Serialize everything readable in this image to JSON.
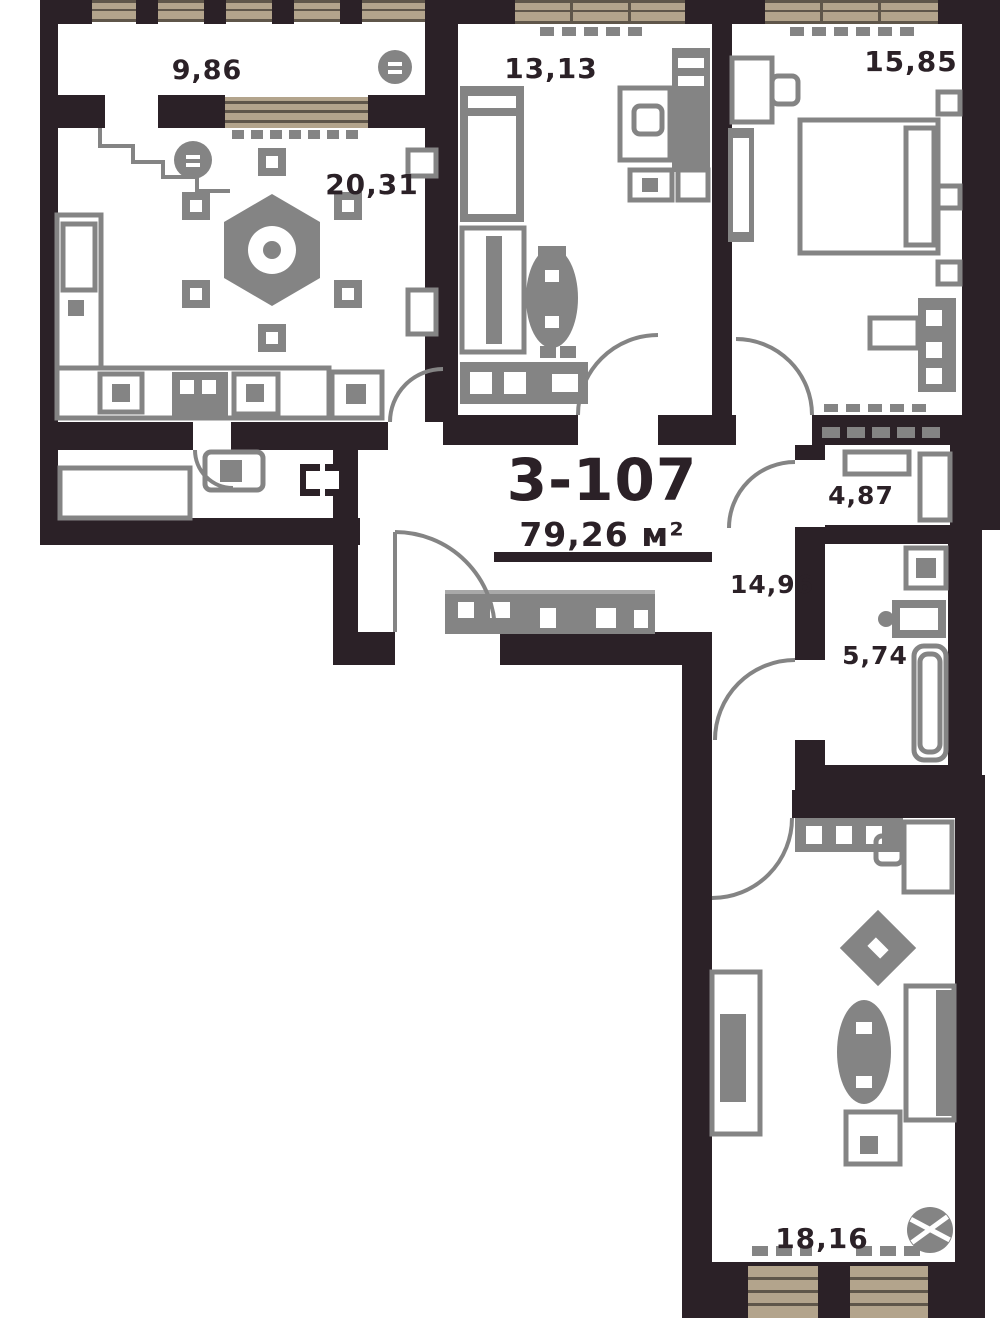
{
  "unit": {
    "number": "3-107",
    "area": "79,26 м²"
  },
  "rooms": {
    "balcony": {
      "area": "9,86"
    },
    "kitchen_living": {
      "area": "20,31"
    },
    "bedroom_middle": {
      "area": "13,13"
    },
    "bedroom_top_right": {
      "area": "15,85"
    },
    "bathroom_small": {
      "area": "4,87"
    },
    "hallway": {
      "area": "14,96"
    },
    "bathroom_large": {
      "area": "5,74"
    },
    "bedroom_bottom": {
      "area": "18,16"
    }
  },
  "colors": {
    "wall": "#2b2127",
    "furniture": "#848484",
    "furniture_light": "#a9a9a9",
    "window": "#b3a48c",
    "window_line": "#5f564a",
    "background": "#ffffff"
  }
}
